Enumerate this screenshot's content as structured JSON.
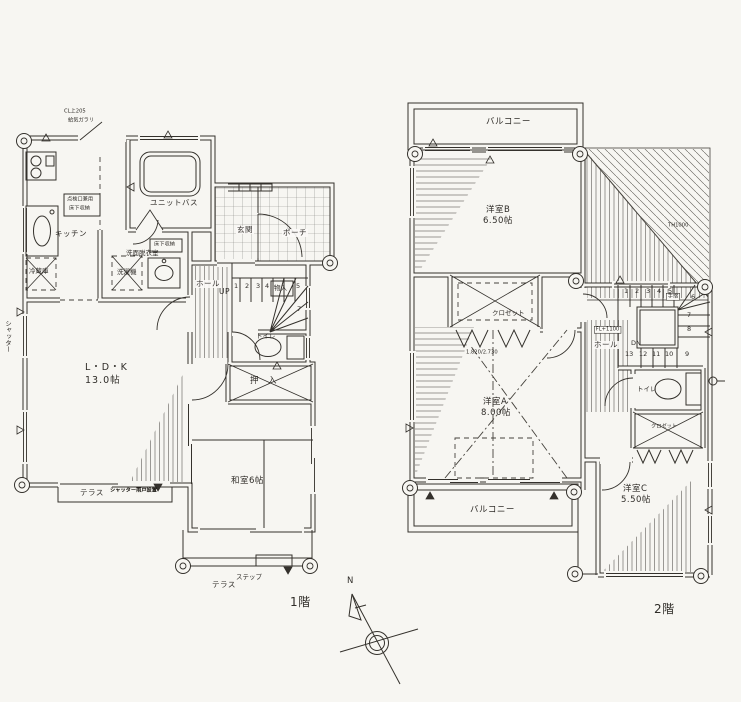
{
  "page": {
    "background": "#f7f6f2",
    "ink": "#34312c"
  },
  "floor1": {
    "title": "1階",
    "rooms": {
      "ldk": "L・D・K",
      "ldk_size": "13.0帖",
      "washitsu": "和室6帖",
      "kitchen": "キッチン",
      "bath": "ユニットバス",
      "washroom": "洗面脱衣室",
      "genkan": "玄関",
      "porch": "ポーチ",
      "hall": "ホール",
      "toilet": "トイレ",
      "oshiire": "押　入"
    },
    "fixtures": {
      "fridge": "冷蔵庫",
      "washer": "洗濯機",
      "underfloor": "床下収納",
      "inspection1": "点検口兼用",
      "inspection2": "床下収納",
      "monoire": "物入"
    },
    "stairs": {
      "up": "UP",
      "n1": "1",
      "n2": "2",
      "n3": "3",
      "n4": "4",
      "n5": "5",
      "n7": "7"
    },
    "outdoor": {
      "terrace_w": "テラス",
      "terrace_note": "シャッター雨戸設置",
      "terrace_s": "テラス",
      "step": "ステップ",
      "shutter": "シャッター"
    },
    "notes": {
      "top1": "CL上205",
      "top2": "給気ガラリ"
    }
  },
  "floor2": {
    "title": "2階",
    "rooms": {
      "roomB": "洋室B",
      "roomB_size": "6.50帖",
      "roomA": "洋室A",
      "roomA_size": "8.00帖",
      "roomC": "洋室C",
      "roomC_size": "5.50帖",
      "hall": "ホール",
      "toilet": "トイレ",
      "closetA": "クロゼット",
      "closetC": "クロゼット"
    },
    "balcony_top": "バルコニー",
    "balcony_bottom": "バルコニー",
    "stairs": {
      "dn": "DN",
      "tesuri": "手摺",
      "fl": "FL+1100",
      "n1": "1",
      "n2": "2",
      "n3": "3",
      "n4": "4",
      "n5": "5",
      "n6": "6",
      "n7": "7",
      "n8": "8",
      "n9": "9",
      "n10": "10",
      "n11": "11",
      "n12": "12",
      "n13": "13"
    },
    "notes": {
      "dim": "1.820/2.730",
      "roof": "TH1000"
    }
  },
  "compass": {
    "north": "N"
  }
}
